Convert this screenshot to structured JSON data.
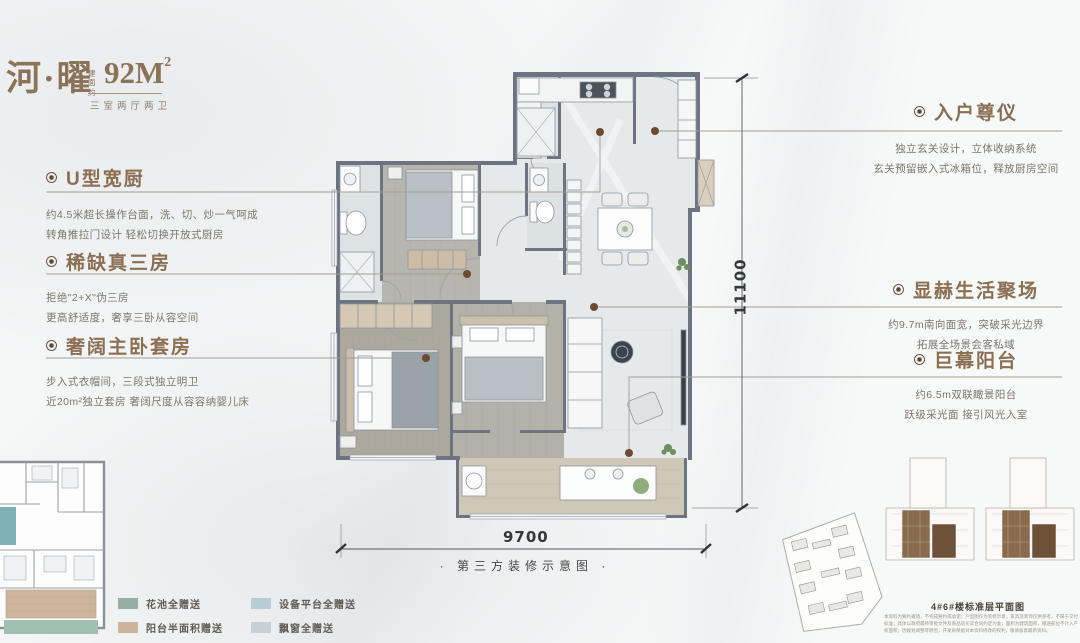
{
  "header": {
    "title": "河·曜",
    "area_prefix": "建面约",
    "area_value": "92M",
    "area_sup": "2",
    "subtitle": "三室两厅两卫"
  },
  "annotations": {
    "left": [
      {
        "title": "U型宽厨",
        "line1": "约4.5米超长操作台面，洗、切、炒一气呵成",
        "line2": "转角推拉门设计 轻松切换开放式厨房"
      },
      {
        "title": "稀缺真三房",
        "line1": "拒绝\"2+X\"伪三房",
        "line2": "更高舒适度，奢享三卧从容空间"
      },
      {
        "title": "奢阔主卧套房",
        "line1": "步入式衣帽间，三段式独立明卫",
        "line2": "近20m²独立套房 奢阔尺度从容容纳婴儿床"
      }
    ],
    "right": [
      {
        "title": "入户尊仪",
        "line1": "独立玄关设计，立体收纳系统",
        "line2": "玄关预留嵌入式冰箱位，释放厨房空间"
      },
      {
        "title": "显赫生活聚场",
        "line1": "约9.7m南向面宽，突破采光边界",
        "line2": "拓展全场景会客私域"
      },
      {
        "title": "巨幕阳台",
        "line1": "约6.5m双联瞰景阳台",
        "line2": "跃级采光面 接引风光入室"
      }
    ]
  },
  "dimensions": {
    "width_mm": "9700",
    "height_mm": "11100"
  },
  "captions": {
    "plan_note": "·  第三方装修示意图  ·",
    "site_caption": "4#6#楼标准层平面图"
  },
  "legend": {
    "items": [
      {
        "label": "花池全赠送",
        "color": "#94afa2"
      },
      {
        "label": "阳台半面积赠送",
        "color": "#cbb49b"
      },
      {
        "label": "设备平台全赠送",
        "color": "#b7cdd6"
      },
      {
        "label": "飘窗全赠送",
        "color": "#c7cfd7"
      }
    ]
  },
  "footer": {
    "disclaimer": "本资料为要约邀请，不构成要约或承诺；户型图仅为装修示意，家具及装饰仅供参考，不属于交付标准；具体以政府最终审批文件及商品房买卖合同约定为准；面积为建筑面积，赠送部位不计入产权面积；因规划调整等原因，开发商保留对本资料修改的权利，敬请留意最新资料。"
  },
  "palette": {
    "accent_brown": "#8a6f52",
    "wall_gray": "#6b7480",
    "leader_dot": "#6e4a2e"
  }
}
